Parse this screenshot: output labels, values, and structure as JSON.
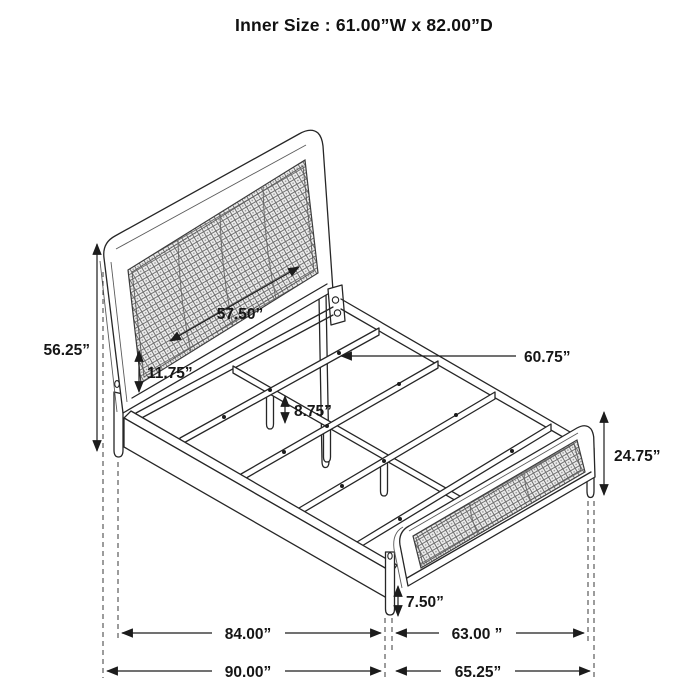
{
  "title": "Inner Size : 61.00”W x 82.00”D",
  "colors": {
    "ink": "#262626",
    "background": "#ffffff",
    "mesh_tone": "#8a8a8a"
  },
  "diagram": {
    "subject": "bed-frame-dimension-diagram",
    "dimension_labels": {
      "headboard_total_height": "56.25”",
      "headboard_inner_width": "57.50”",
      "under_headboard_clearance": "11.75”",
      "slat_support_leg_height": "8.75”",
      "slat_length": "60.75”",
      "footboard_height": "24.75”",
      "footboard_leg_height": "7.50”",
      "inner_length": "84.00”",
      "footboard_inner_width": "63.00 ”",
      "overall_length": "90.00”",
      "overall_width": "65.25”"
    }
  }
}
